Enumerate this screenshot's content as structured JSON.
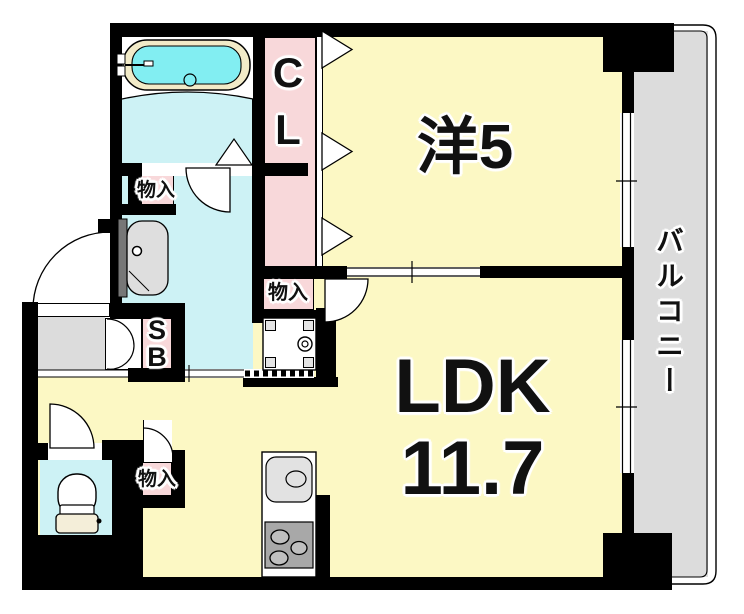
{
  "plan": {
    "labels": {
      "western_room": "洋5",
      "ldk_name": "LDK",
      "ldk_size": "11.7",
      "balcony": "バルコニー",
      "closet": "CL",
      "shoe_box": "SB",
      "storage_upper": "物入",
      "storage_middle": "物入",
      "storage_lower": "物入"
    },
    "colors": {
      "room_yellow": "#fcf8c4",
      "closet_pink": "#f8d8da",
      "wet_area_cyan": "#cdf2f5",
      "bath_water": "#82eef2",
      "tub_rim": "#f2ebc8",
      "balcony_gray": "#dcdcdc",
      "wall": "#000000"
    }
  }
}
